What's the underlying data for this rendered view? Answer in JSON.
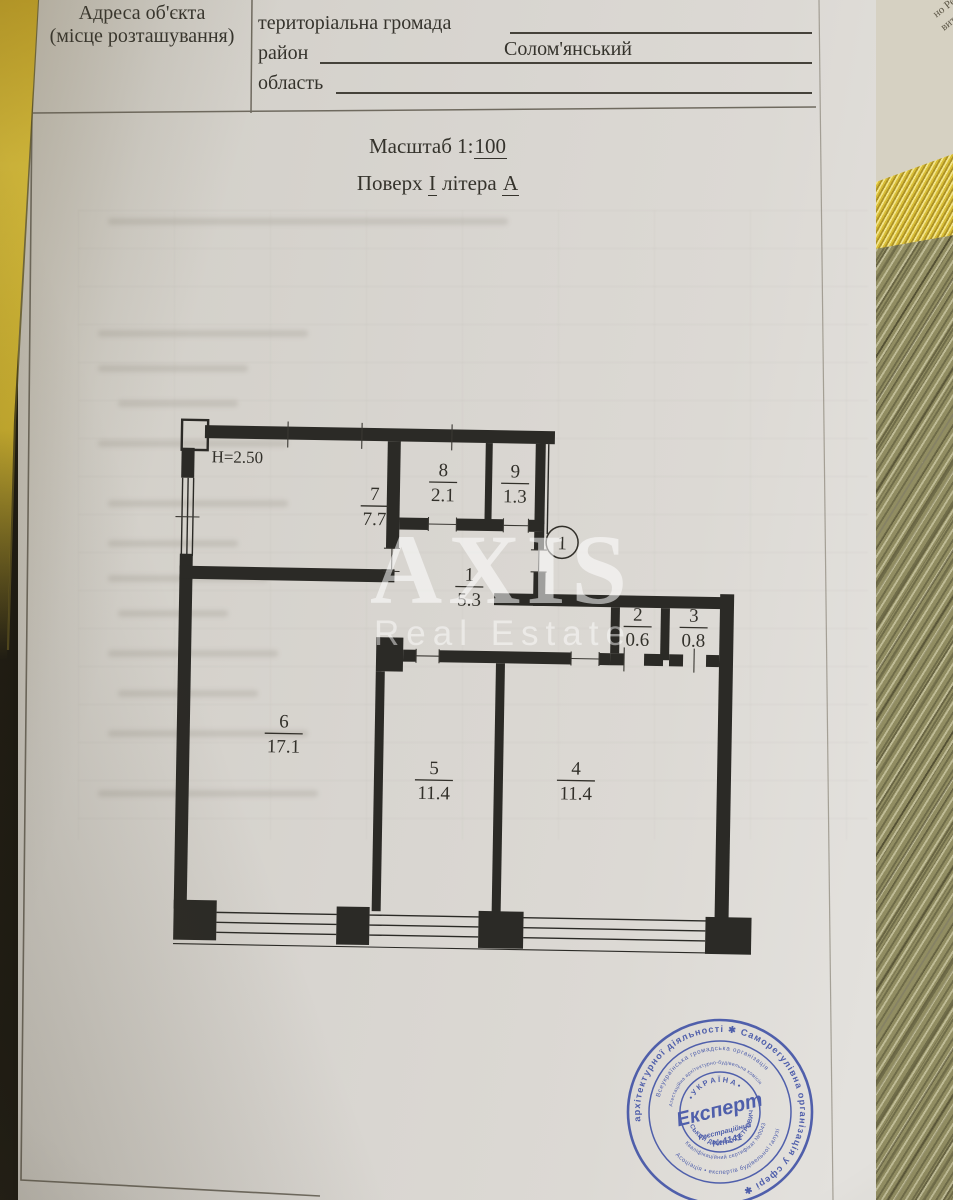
{
  "document": {
    "header": {
      "address_label_line1": "Адреса об'єкта",
      "address_label_line2": "(місце розташування)",
      "rows": [
        {
          "label": "територіальна громада",
          "value": ""
        },
        {
          "label": "район",
          "value": "Солом'янський"
        },
        {
          "label": "область",
          "value": ""
        }
      ]
    },
    "scale": {
      "prefix": "Масштаб 1:",
      "value": "100"
    },
    "floor_line": {
      "floor_label": "Поверх",
      "floor_value": "І",
      "letter_label": "літера",
      "letter_value": "А"
    },
    "plan": {
      "ceiling_height": "Н=2.50",
      "entrance_mark": "1",
      "rooms": [
        {
          "number": "7",
          "area": "7.7"
        },
        {
          "number": "8",
          "area": "2.1"
        },
        {
          "number": "9",
          "area": "1.3"
        },
        {
          "number": "1",
          "area": "5.3"
        },
        {
          "number": "2",
          "area": "0.6"
        },
        {
          "number": "3",
          "area": "0.8"
        },
        {
          "number": "6",
          "area": "17.1"
        },
        {
          "number": "5",
          "area": "11.4"
        },
        {
          "number": "4",
          "area": "11.4"
        }
      ]
    },
    "watermark": {
      "title": "AXIS",
      "subtitle": "Real Estate"
    },
    "stamp": {
      "outer_ring": "архітектурної діяльності ✱ Саморегулівна організація у сфері ✱",
      "ring2_top": "Всеукраїнська громадська організація",
      "ring2_bottom": "Асоціація • експертів будівельної галузі",
      "ring3_top": "Атестаційна архітектурно-будівельна комісія",
      "ring3_bottom": "Кваліфікаційний сертифікат №0043",
      "name_arc": "СЬКИЙ ДМИТРО ПЕТРОВИЧ",
      "country": "• У К Р А Ї Н А •",
      "title": "Експерт",
      "registration_label": "Реєстраційний",
      "registration_number": "№4141"
    },
    "background_page_fragments": [
      "Свідоцтва про",
      "05 грудня 20",
      "но Реєстраційн",
      "витягом з Держ",
      "у: 15712767, н",
      "980000, видано",
      "і Рішення Сол",
      "ованого в Держ",
      "онавчого орга"
    ]
  },
  "colors": {
    "paper": "#d8d5d0",
    "ink": "#35332c",
    "plan_line": "#2b2a26",
    "stamp_blue": "#3c4ea5",
    "folder_yellow": "#e2c63a",
    "watermark_white": "#ffffff"
  }
}
